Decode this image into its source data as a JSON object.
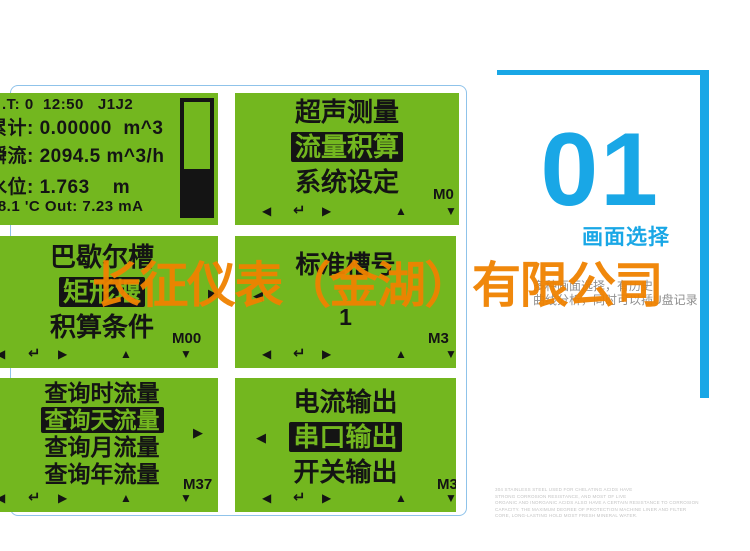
{
  "colors": {
    "lcd_green": "#73b71f",
    "accent_blue": "#19a7e6",
    "watermark_orange": "#f08200"
  },
  "watermark": "长征仪表（金湖）有限公司",
  "nav": {
    "left": "◀",
    "enter": "↵",
    "right": "▶",
    "up": "▲",
    "down": "▼"
  },
  "screens": [
    {
      "name": "main-display",
      "lines": [
        ".T: 0  12:50   J1J2",
        "累计: 0.00000  m^3",
        "瞬流: 2094.5 m^3/h",
        "水位: 1.763    m",
        "18.1 'C Out: 7.23 mA"
      ]
    },
    {
      "name": "main-menu",
      "items": [
        {
          "label": "超声测量",
          "selected": false
        },
        {
          "label": "流量积算",
          "selected": true
        },
        {
          "label": "系统设定",
          "selected": false
        }
      ],
      "mcode": "M0"
    },
    {
      "name": "flume-menu",
      "items": [
        {
          "label": "巴歇尔槽",
          "selected": false
        },
        {
          "label": "矩形堰",
          "selected": true
        },
        {
          "label": "积算条件",
          "selected": false
        }
      ],
      "mcode": "M00",
      "indicator": "▶"
    },
    {
      "name": "standard-flume",
      "title": "标准槽号",
      "value": "1",
      "mcode": "M3",
      "indicator": "◀"
    },
    {
      "name": "query-menu",
      "items": [
        {
          "label": "查询时流量",
          "selected": false
        },
        {
          "label": "查询天流量",
          "selected": true
        },
        {
          "label": "查询月流量",
          "selected": false
        },
        {
          "label": "查询年流量",
          "selected": false
        }
      ],
      "mcode": "M37",
      "indicator": "▶"
    },
    {
      "name": "output-menu",
      "items": [
        {
          "label": "电流输出",
          "selected": false
        },
        {
          "label": "串口输出",
          "selected": true
        },
        {
          "label": "开关输出",
          "selected": false
        }
      ],
      "mcode": "M3",
      "indicator": "◀"
    }
  ],
  "side": {
    "number": "01",
    "title": "画面选择",
    "description": [
      "多种画面选择，有历史",
      "曲线分析，同时可以插U盘记录"
    ],
    "fine_print": [
      "304 STAINLESS STEEL USED FOR CHELATING ACIDS HAVE",
      "STRONG CORROSION RESISTANCE, AND MOST OF LIVE",
      "ORGANIC AND INORGANIC ACIDS ALSO HAVE A CERTAIN RESISTANCE TO CORROSION",
      "CAPACITY. THE MAXIMUM DEGREE OF PROTECTION MACHINE LINER AND FILTER",
      "CORE, LONG-LASTING HOLD MOST FRESH MINERAL WATER."
    ]
  }
}
